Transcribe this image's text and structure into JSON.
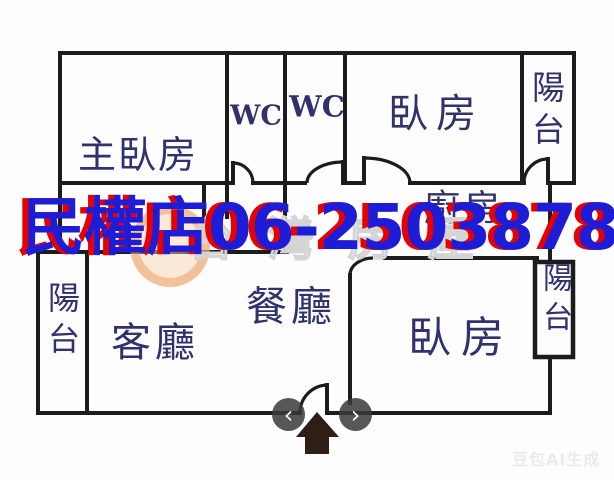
{
  "overlay": {
    "store_phone": "民權店06-2503878",
    "phone_color": "#1d1dd8",
    "phone_shadow_color": "#e80000",
    "ghost_watermark": "台灣房屋",
    "ai_watermark": "豆包AI生成"
  },
  "rooms": {
    "master_bedroom": {
      "label": "主臥房"
    },
    "wc_left": {
      "label": "WC"
    },
    "wc_right": {
      "label": "WC"
    },
    "bedroom_top": {
      "label": "臥房"
    },
    "balcony_top_right": {
      "label": "陽台"
    },
    "kitchen": {
      "label": "廚房"
    },
    "dining": {
      "label": "餐廳"
    },
    "living": {
      "label": "客廳"
    },
    "balcony_left": {
      "label": "陽台"
    },
    "bedroom_bottom": {
      "label": "臥房"
    },
    "balcony_right": {
      "label": "陽台"
    }
  },
  "nav": {
    "prev_label": "‹",
    "next_label": "›"
  },
  "colors": {
    "wall": "#1c1c1c",
    "room_label": "#31316e",
    "entrance_arrow": "#241209"
  }
}
